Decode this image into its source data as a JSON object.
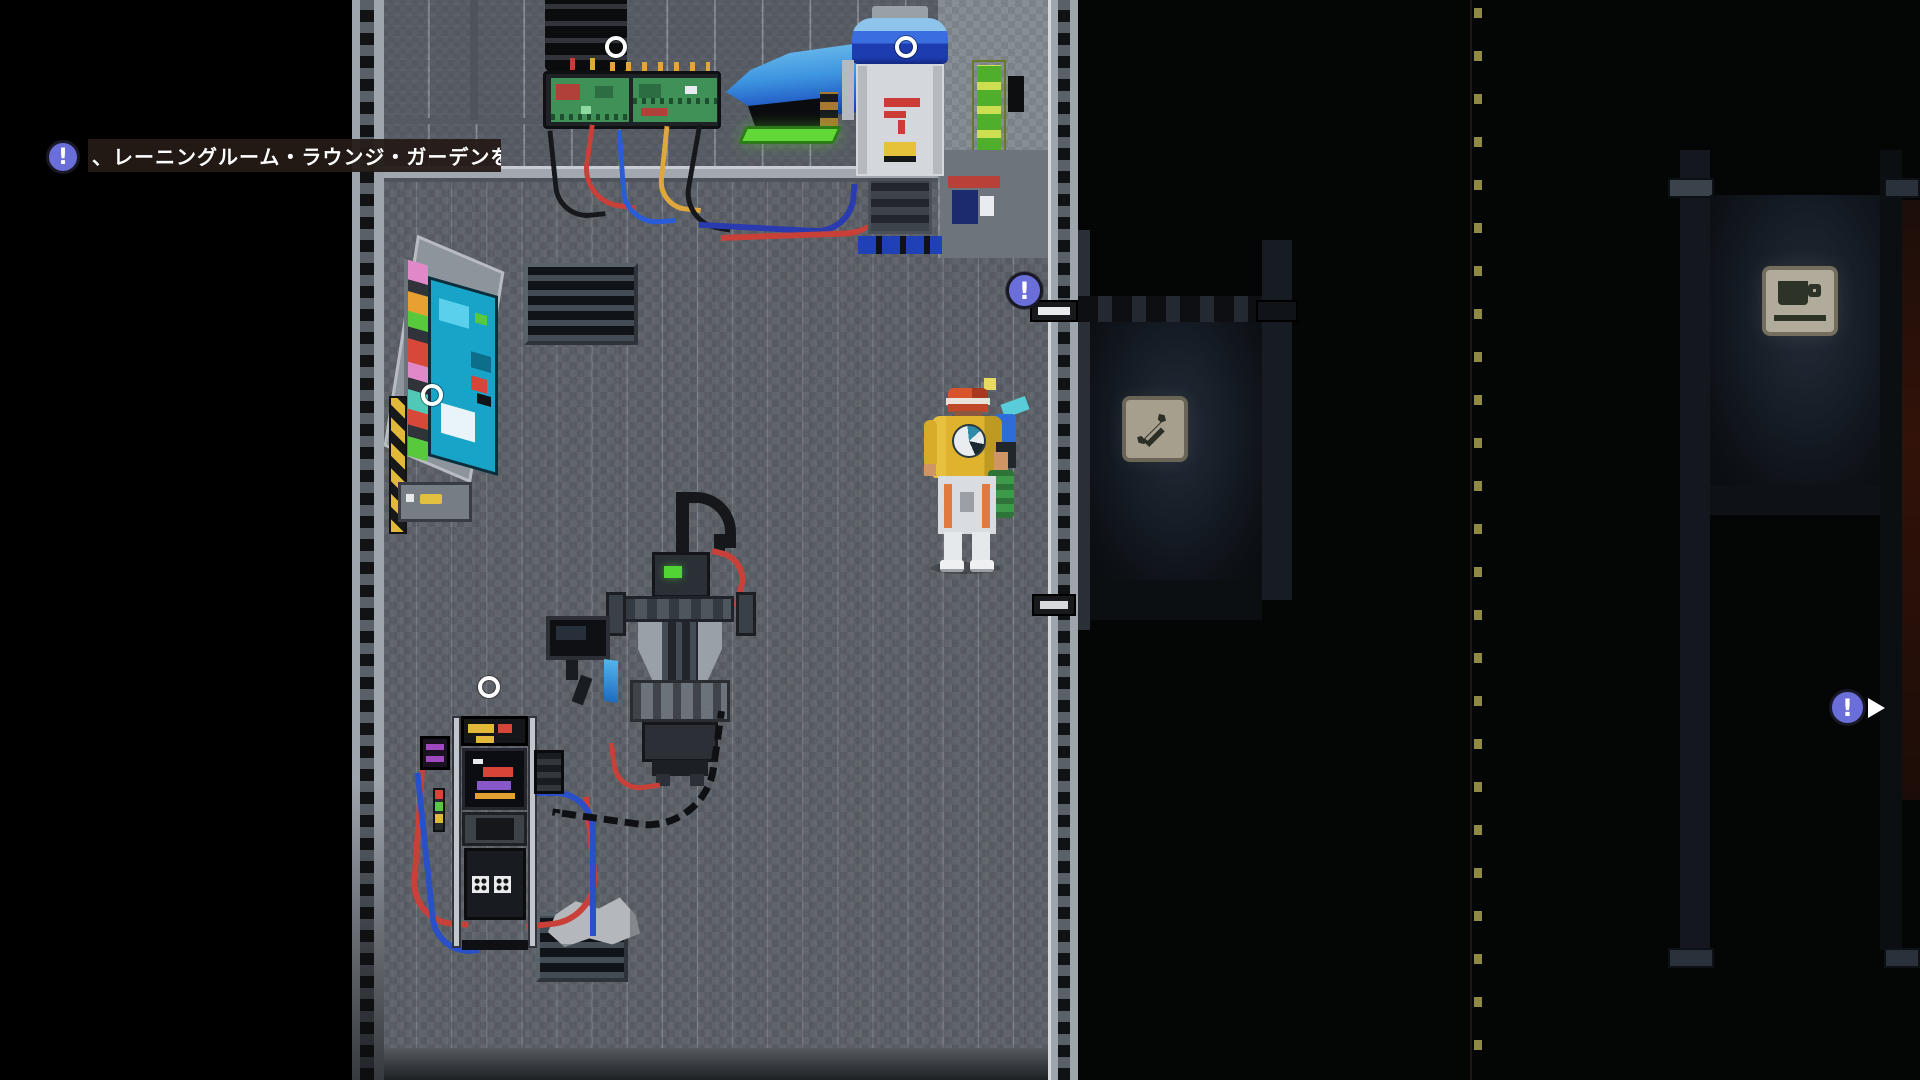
{
  "scene": {
    "description": "pixel-art sci-fi workshop room with dark corridor",
    "tooltip": {
      "icon": "!",
      "text": "、レーニングルーム・ラウンジ・ガーデンを扌"
    },
    "badges": {
      "exclamation": "!"
    },
    "icons": {
      "alert_badge": "!",
      "play_triangle": "right-pointing-triangle",
      "interaction_circle": "hollow-white-circle",
      "wrench_sign": "wrench-glyph",
      "coffee_sign": "coffee-cup-glyph"
    },
    "interaction_points": [
      "tower-machine",
      "robot-unit",
      "wall-console",
      "arcade-machine"
    ],
    "colors": {
      "badge_blue": "#6a6ed8",
      "marker_white": "#ffffff",
      "tooltip_bg": "#241b16",
      "hazard_yellow": "#e2b838",
      "console_cyan": "#17a4c8",
      "jet_blue": "#2e86d8",
      "battery_lime": "#cede52",
      "pcb_green": "#3f9158",
      "dash_line_yellow": "#8f8a42"
    }
  }
}
